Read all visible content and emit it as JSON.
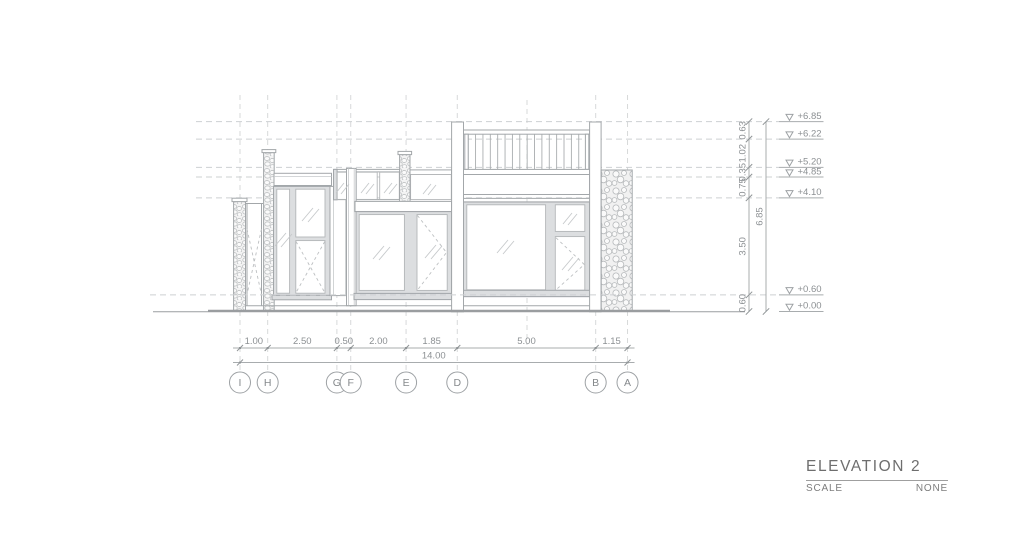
{
  "title_block": {
    "title": "ELEVATION 2",
    "scale_label": "SCALE",
    "scale_value": "NONE"
  },
  "levels": [
    {
      "label": "+6.85",
      "value": 6.85
    },
    {
      "label": "+6.22",
      "value": 6.22
    },
    {
      "label": "+5.20",
      "value": 5.2
    },
    {
      "label": "+4.85",
      "value": 4.85
    },
    {
      "label": "+4.10",
      "value": 4.1
    },
    {
      "label": "+0.60",
      "value": 0.6
    },
    {
      "label": "+0.00",
      "value": 0.0
    }
  ],
  "vertical_dims": [
    {
      "label": "0.63",
      "from": 6.22,
      "to": 6.85
    },
    {
      "label": "1.02",
      "from": 5.2,
      "to": 6.22
    },
    {
      "label": "0.35",
      "from": 4.85,
      "to": 5.2
    },
    {
      "label": "0.75",
      "from": 4.1,
      "to": 4.85
    },
    {
      "label": "3.50",
      "from": 0.6,
      "to": 4.1
    },
    {
      "label": "0.60",
      "from": 0.0,
      "to": 0.6
    }
  ],
  "overall_vertical_dim": {
    "label": "6.85",
    "from": 0.0,
    "to": 6.85
  },
  "grids": [
    {
      "label": "I",
      "m": 0.0
    },
    {
      "label": "H",
      "m": 1.0
    },
    {
      "label": "G",
      "m": 3.5
    },
    {
      "label": "F",
      "m": 4.0
    },
    {
      "label": "E",
      "m": 6.0
    },
    {
      "label": "D",
      "m": 7.85
    },
    {
      "label": "B",
      "m": 12.85
    },
    {
      "label": "A",
      "m": 14.0
    }
  ],
  "horizontal_dims": [
    "1.00",
    "2.50",
    "0.50",
    "2.00",
    "1.85",
    "5.00",
    "1.15"
  ],
  "overall_horizontal_dim": "14.00"
}
